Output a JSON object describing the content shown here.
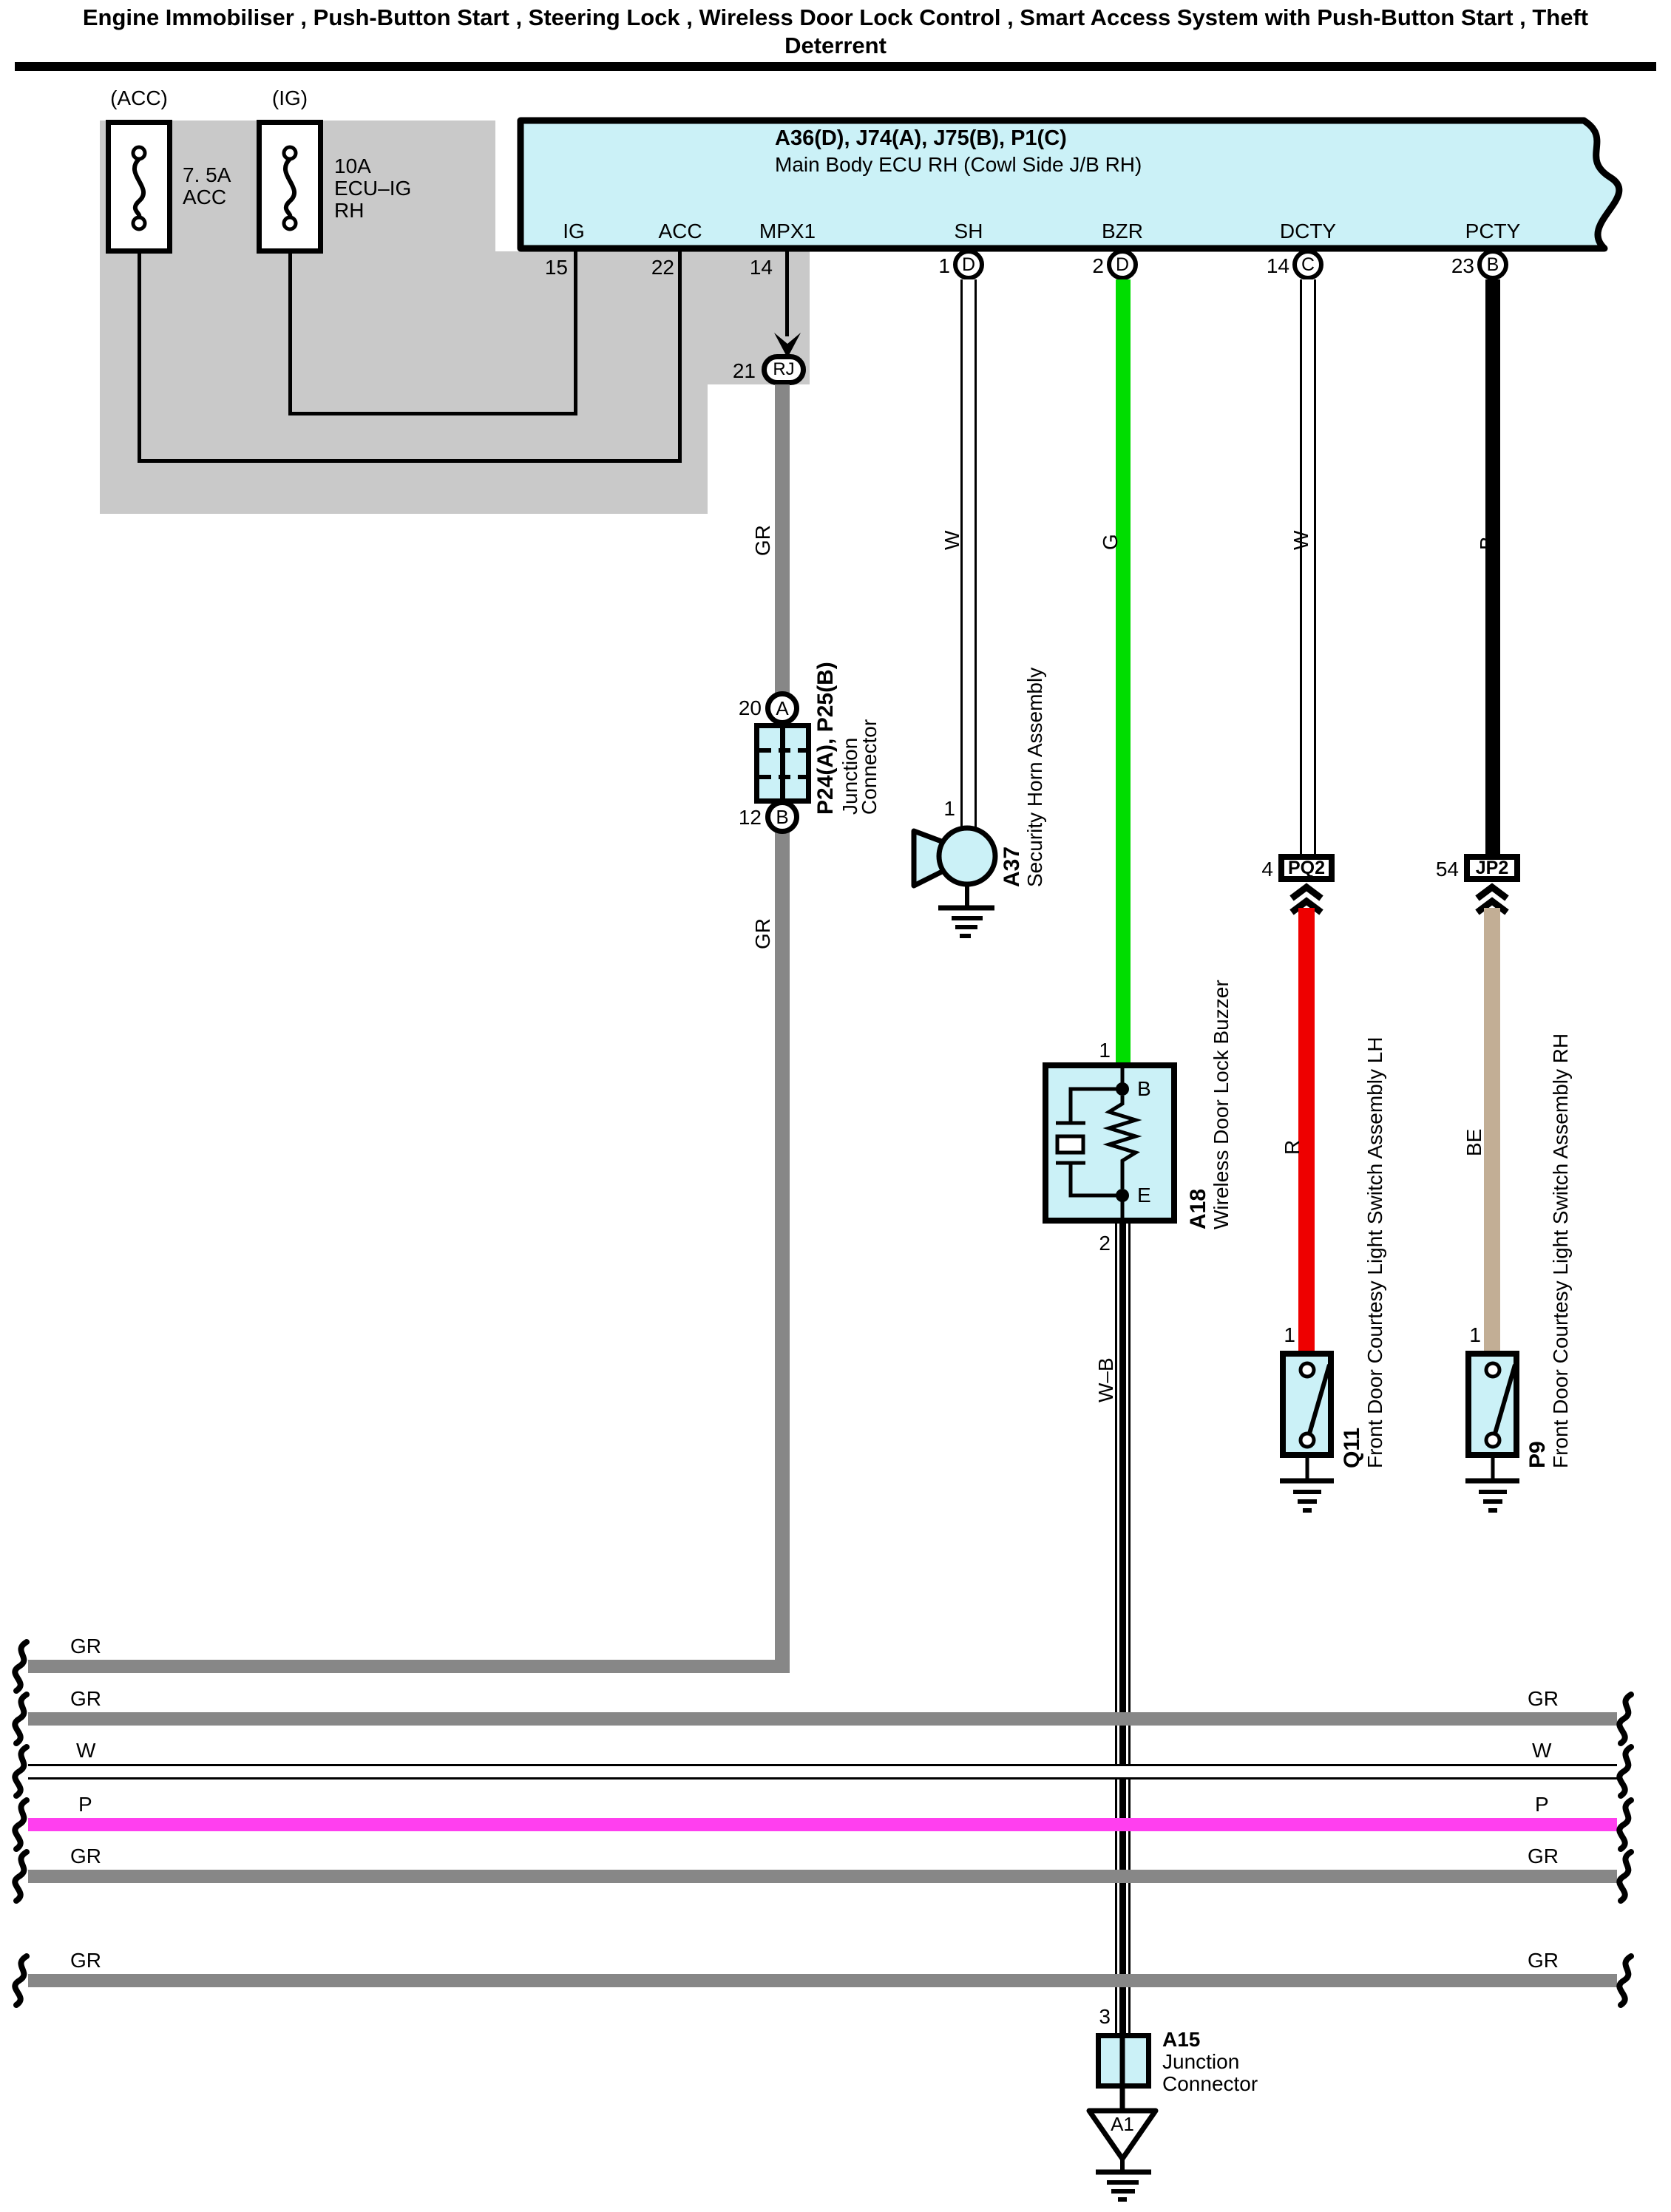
{
  "title": {
    "line1": "Engine Immobiliser , Push-Button Start , Steering Lock , Wireless Door Lock Control , Smart Access System with Push-Button Start , Theft",
    "line2": "Deterrent"
  },
  "fuses": {
    "acc": {
      "tag": "(ACC)",
      "rating": "7. 5A",
      "name": "ACC"
    },
    "ig": {
      "tag": "(IG)",
      "rating": "10A",
      "name_line1": "ECU–IG",
      "name_line2": "RH"
    }
  },
  "ecu": {
    "connectors": "A36(D), J74(A), J75(B), P1(C)",
    "name": "Main Body ECU RH (Cowl Side J/B RH)",
    "pins": [
      {
        "label": "IG",
        "number": "15"
      },
      {
        "label": "ACC",
        "number": "22"
      },
      {
        "label": "MPX1",
        "number": "14"
      },
      {
        "label": "SH",
        "number": "1",
        "circle": "D"
      },
      {
        "label": "BZR",
        "number": "2",
        "circle": "D"
      },
      {
        "label": "DCTY",
        "number": "14",
        "circle": "C"
      },
      {
        "label": "PCTY",
        "number": "23",
        "circle": "B"
      }
    ]
  },
  "rj": {
    "number": "21",
    "label": "RJ"
  },
  "junction_p24": {
    "pin_a": "20",
    "circle_a": "A",
    "pin_b": "12",
    "circle_b": "B",
    "code": "P24(A), P25(B)",
    "name_line1": "Junction",
    "name_line2": "Connector"
  },
  "horn": {
    "pin": "1",
    "code": "A37",
    "name": "Security Horn Assembly"
  },
  "buzzer": {
    "pin_top": "1",
    "terminal_top": "B",
    "terminal_bottom": "E",
    "pin_bottom": "2",
    "code": "A18",
    "name": "Wireless Door Lock Buzzer"
  },
  "pq2": {
    "number": "4",
    "label": "PQ2"
  },
  "jp2": {
    "number": "54",
    "label": "JP2"
  },
  "q11": {
    "pin": "1",
    "code": "Q11",
    "name": "Front Door Courtesy Light Switch Assembly LH"
  },
  "p9": {
    "pin": "1",
    "code": "P9",
    "name": "Front Door Courtesy Light Switch Assembly RH"
  },
  "a15": {
    "pin": "3",
    "code": "A15",
    "name_line1": "Junction",
    "name_line2": "Connector",
    "ground": "A1"
  },
  "wire_labels": {
    "mpx_upper": "GR",
    "mpx_lower": "GR",
    "sh": "W",
    "bzr": "G",
    "dcty": "W",
    "pcty": "B",
    "courtesy_lh": "R",
    "courtesy_rh": "BE",
    "buzzer_ground": "W–B"
  },
  "buses": [
    {
      "left": "GR",
      "right": ""
    },
    {
      "left": "GR",
      "right": "GR"
    },
    {
      "left": "W",
      "right": "W"
    },
    {
      "left": "P",
      "right": "P"
    },
    {
      "left": "GR",
      "right": "GR"
    },
    {
      "left": "GR",
      "right": "GR"
    }
  ],
  "colors": {
    "cyan": "#CBF1F7",
    "gray-bg": "#C9C9C9",
    "wire-gray": "#878787",
    "wire-green": "#00DD00",
    "wire-red": "#EE0000",
    "wire-tan": "#C2AE95",
    "wire-pink": "#FF3FEF"
  }
}
